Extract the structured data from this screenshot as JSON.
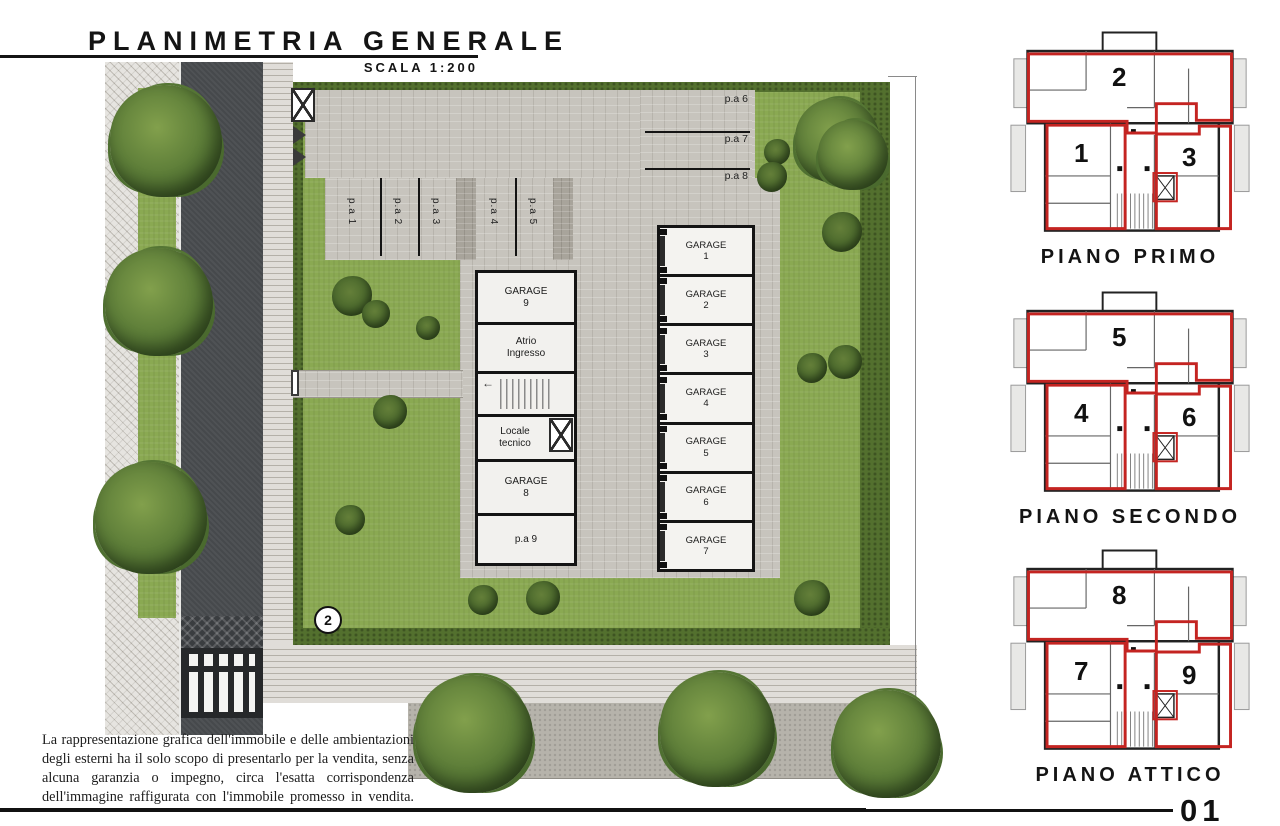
{
  "title": {
    "main": "PLANIMETRIA GENERALE",
    "scale": "SCALA 1:200"
  },
  "site": {
    "marker_label": "2",
    "parking": {
      "left_stalls": [
        "p.a 1",
        "p.a 2",
        "p.a 3",
        "p.a 4",
        "p.a 5"
      ],
      "top_stalls": [
        "p.a 6",
        "p.a 7",
        "p.a 8"
      ]
    },
    "building": {
      "garage_word": "GARAGE",
      "right_garages": [
        "1",
        "2",
        "3",
        "4",
        "5",
        "6",
        "7"
      ],
      "left_rooms": {
        "garage9_label": "GARAGE",
        "garage9_num": "9",
        "atrio": "Atrio Ingresso",
        "locale": "Locale tecnico",
        "garage8_label": "GARAGE",
        "garage8_num": "8",
        "pa9": "p.a 9"
      }
    }
  },
  "floor_plans": [
    {
      "label": "PIANO PRIMO",
      "units": {
        "left": "1",
        "top": "2",
        "right": "3"
      }
    },
    {
      "label": "PIANO SECONDO",
      "units": {
        "left": "4",
        "top": "5",
        "right": "6"
      }
    },
    {
      "label": "PIANO ATTICO",
      "units": {
        "left": "7",
        "top": "8",
        "right": "9"
      }
    }
  ],
  "disclaimer": "La rappresentazione grafica dell'immobile e delle ambientazioni degli esterni ha il solo scopo di presentarlo per la vendita, senza alcuna garanzia o impegno, circa l'esatta corrispondenza dell'immagine raffigurata con l'immobile promesso in vendita.",
  "page_number": "01",
  "colors": {
    "red_outline": "#c42421",
    "lawn": "#8aa952",
    "asphalt": "#46494c",
    "pavement": "#c7c4bd"
  }
}
